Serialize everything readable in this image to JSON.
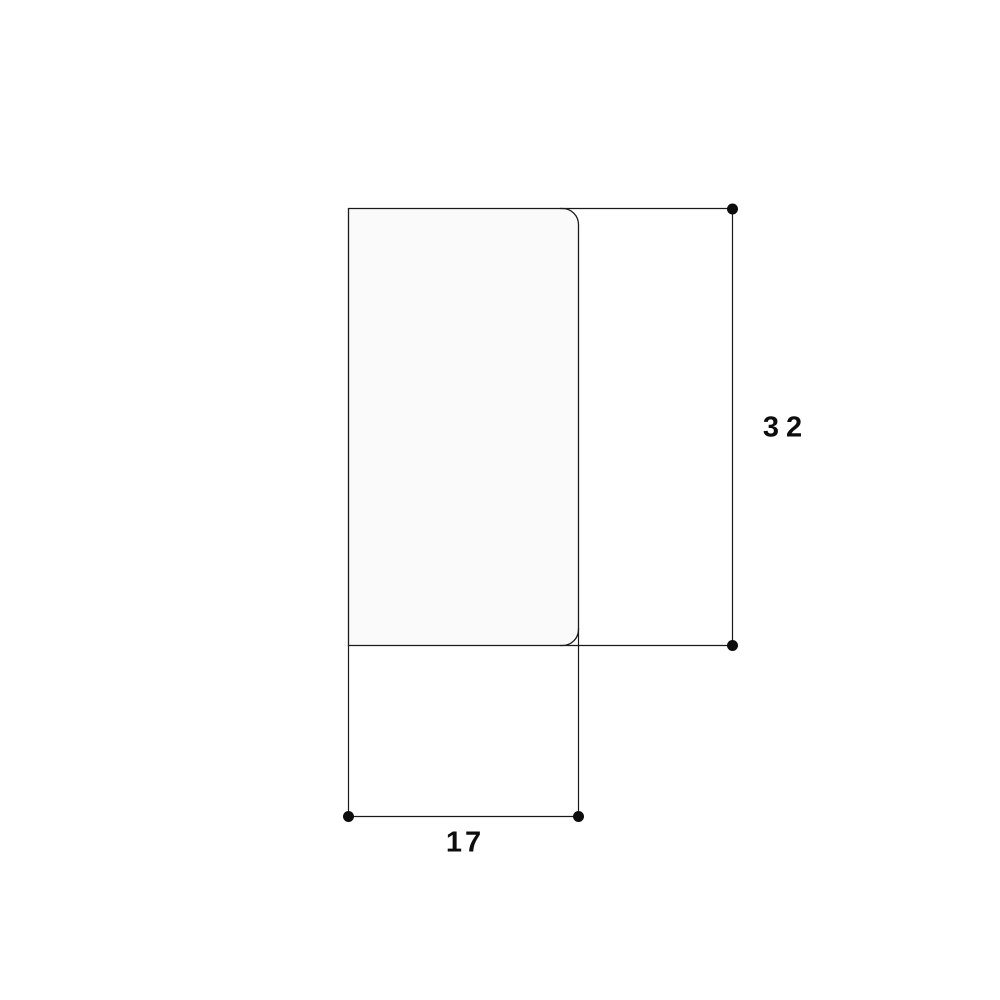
{
  "figure": {
    "background_color": "#ffffff",
    "shape": {
      "type": "rounded-rectangle-profile",
      "fill": "#fafafa",
      "stroke": "#1a1a1a"
    },
    "line_color": "#1a1a1a",
    "marker_color": "#0d0d0d",
    "dimensions": {
      "height": {
        "value": "32"
      },
      "width": {
        "value": "17"
      }
    }
  }
}
